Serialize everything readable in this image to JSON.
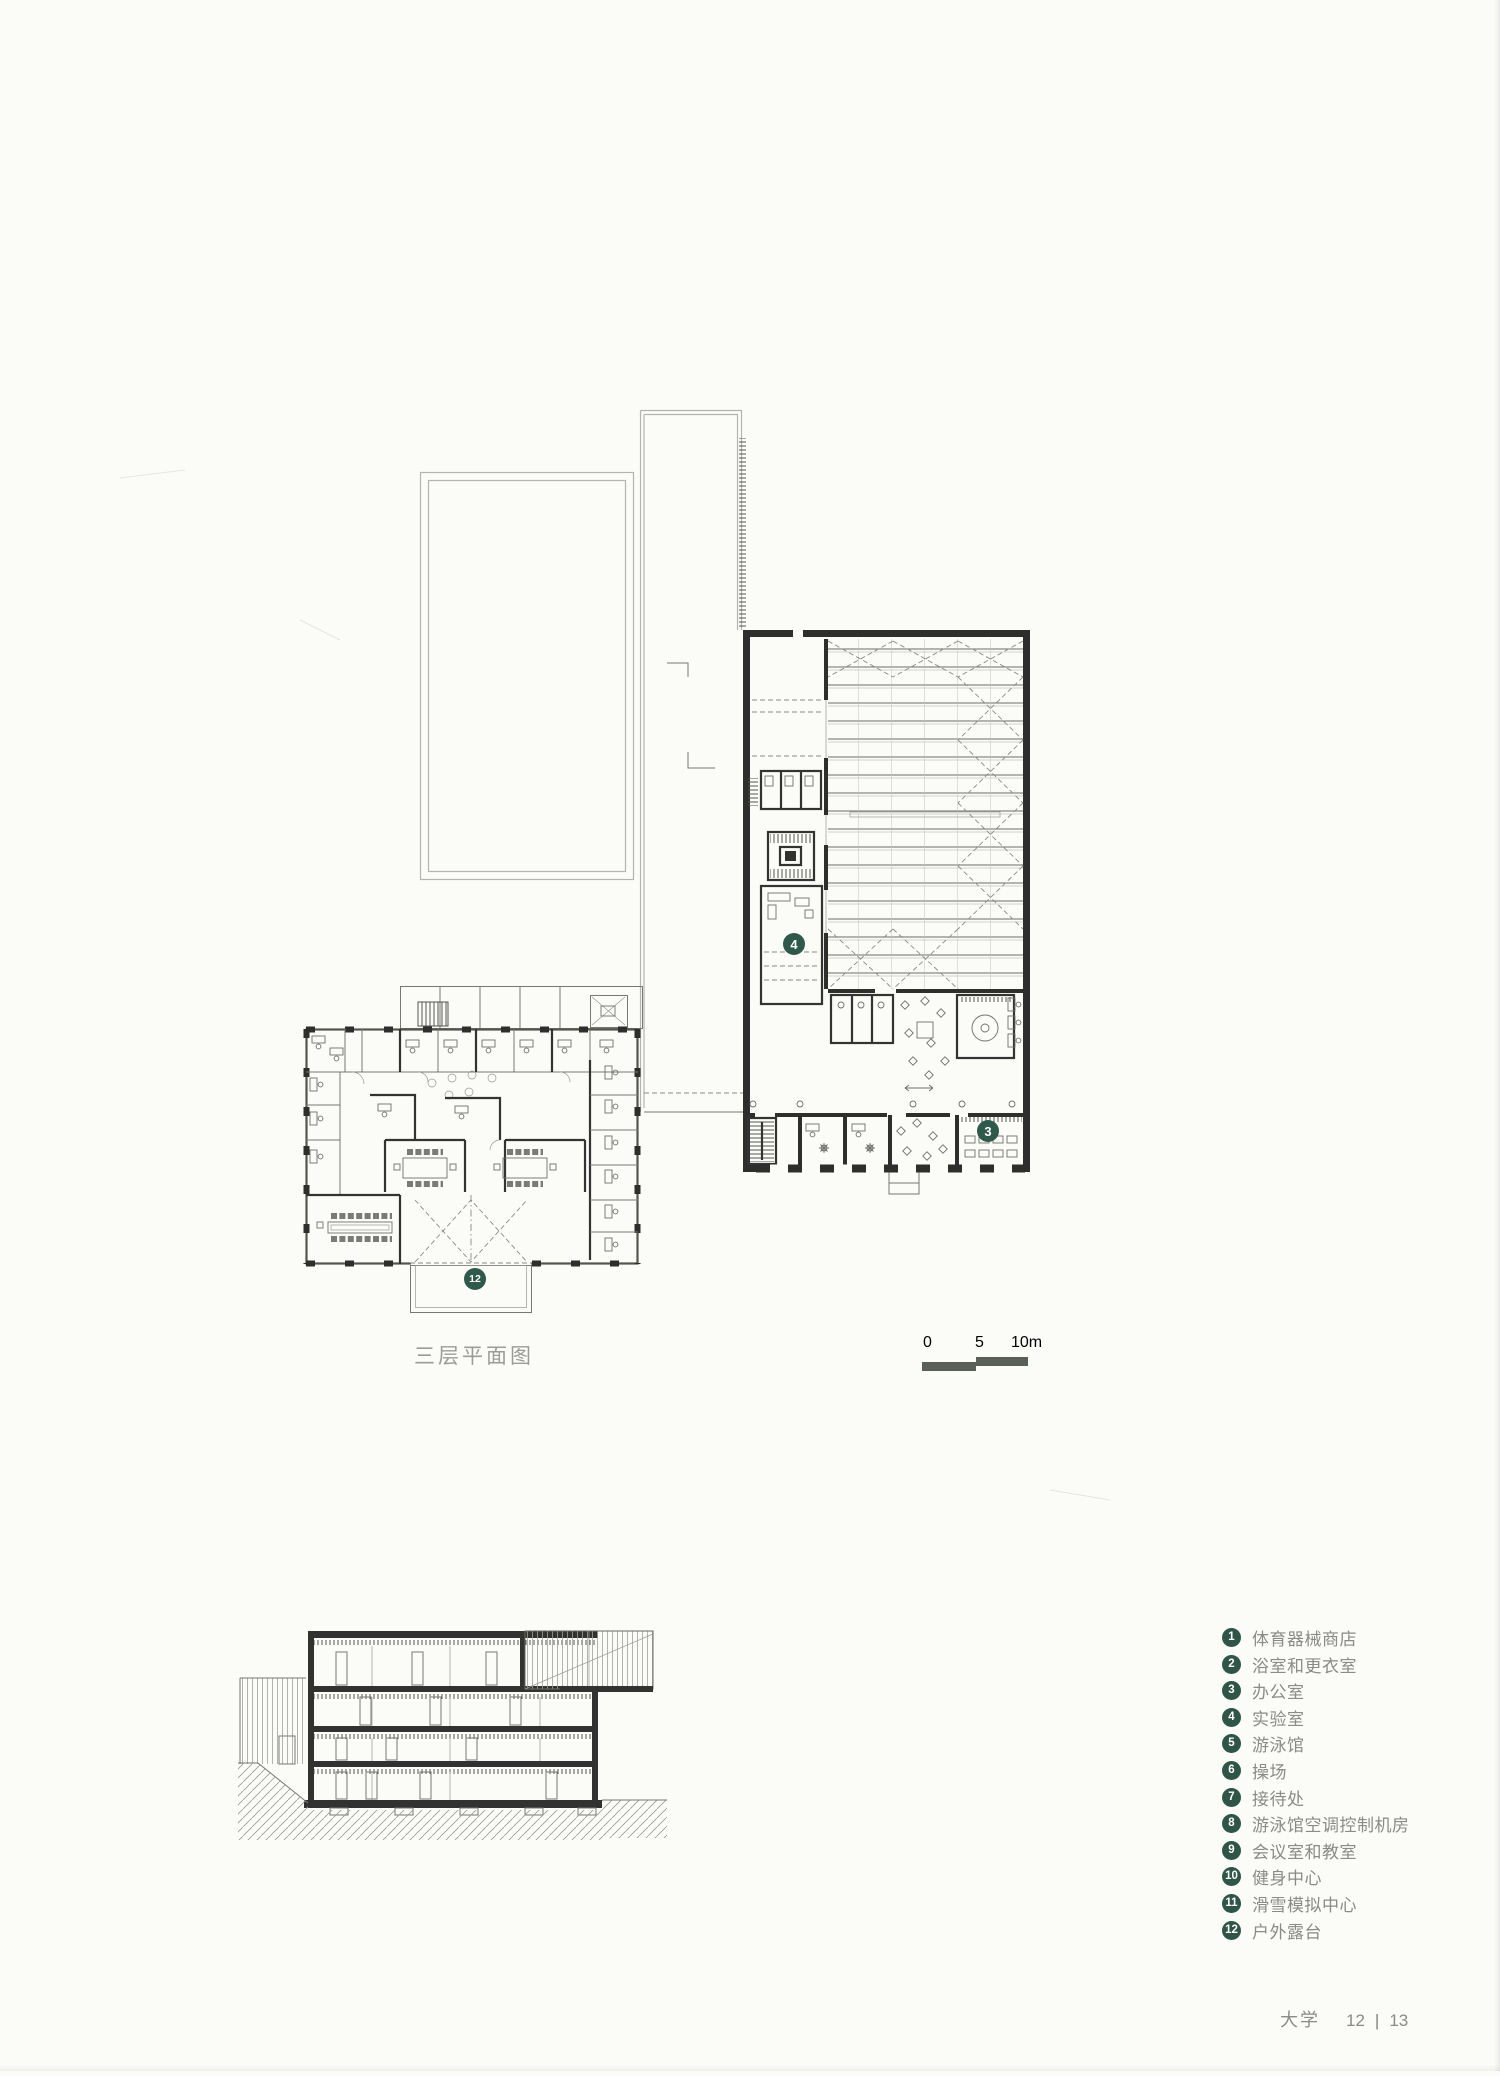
{
  "page": {
    "caption": "三层平面图",
    "footer": {
      "title": "大学",
      "page_left": "12",
      "separator": "|",
      "page_right": "13"
    }
  },
  "scale_bar": {
    "labels": [
      "0",
      "5",
      "10m"
    ]
  },
  "markers": {
    "lab": "4",
    "office": "3",
    "terrace": "12"
  },
  "legend": {
    "items": [
      {
        "num": "1",
        "label": "体育器械商店"
      },
      {
        "num": "2",
        "label": "浴室和更衣室"
      },
      {
        "num": "3",
        "label": "办公室"
      },
      {
        "num": "4",
        "label": "实验室"
      },
      {
        "num": "5",
        "label": "游泳馆"
      },
      {
        "num": "6",
        "label": "操场"
      },
      {
        "num": "7",
        "label": "接待处"
      },
      {
        "num": "8",
        "label": "游泳馆空调控制机房"
      },
      {
        "num": "9",
        "label": "会议室和教室"
      },
      {
        "num": "10",
        "label": "健身中心"
      },
      {
        "num": "11",
        "label": "滑雪模拟中心"
      },
      {
        "num": "12",
        "label": "户外露台"
      }
    ]
  },
  "colors": {
    "paper": "#fbfbf8",
    "marker": "#2f5a4b",
    "legend_circle": "#2e5547",
    "text": "#8a8a87",
    "caption": "#9b9b97",
    "scalebar": "#5a5f57"
  }
}
